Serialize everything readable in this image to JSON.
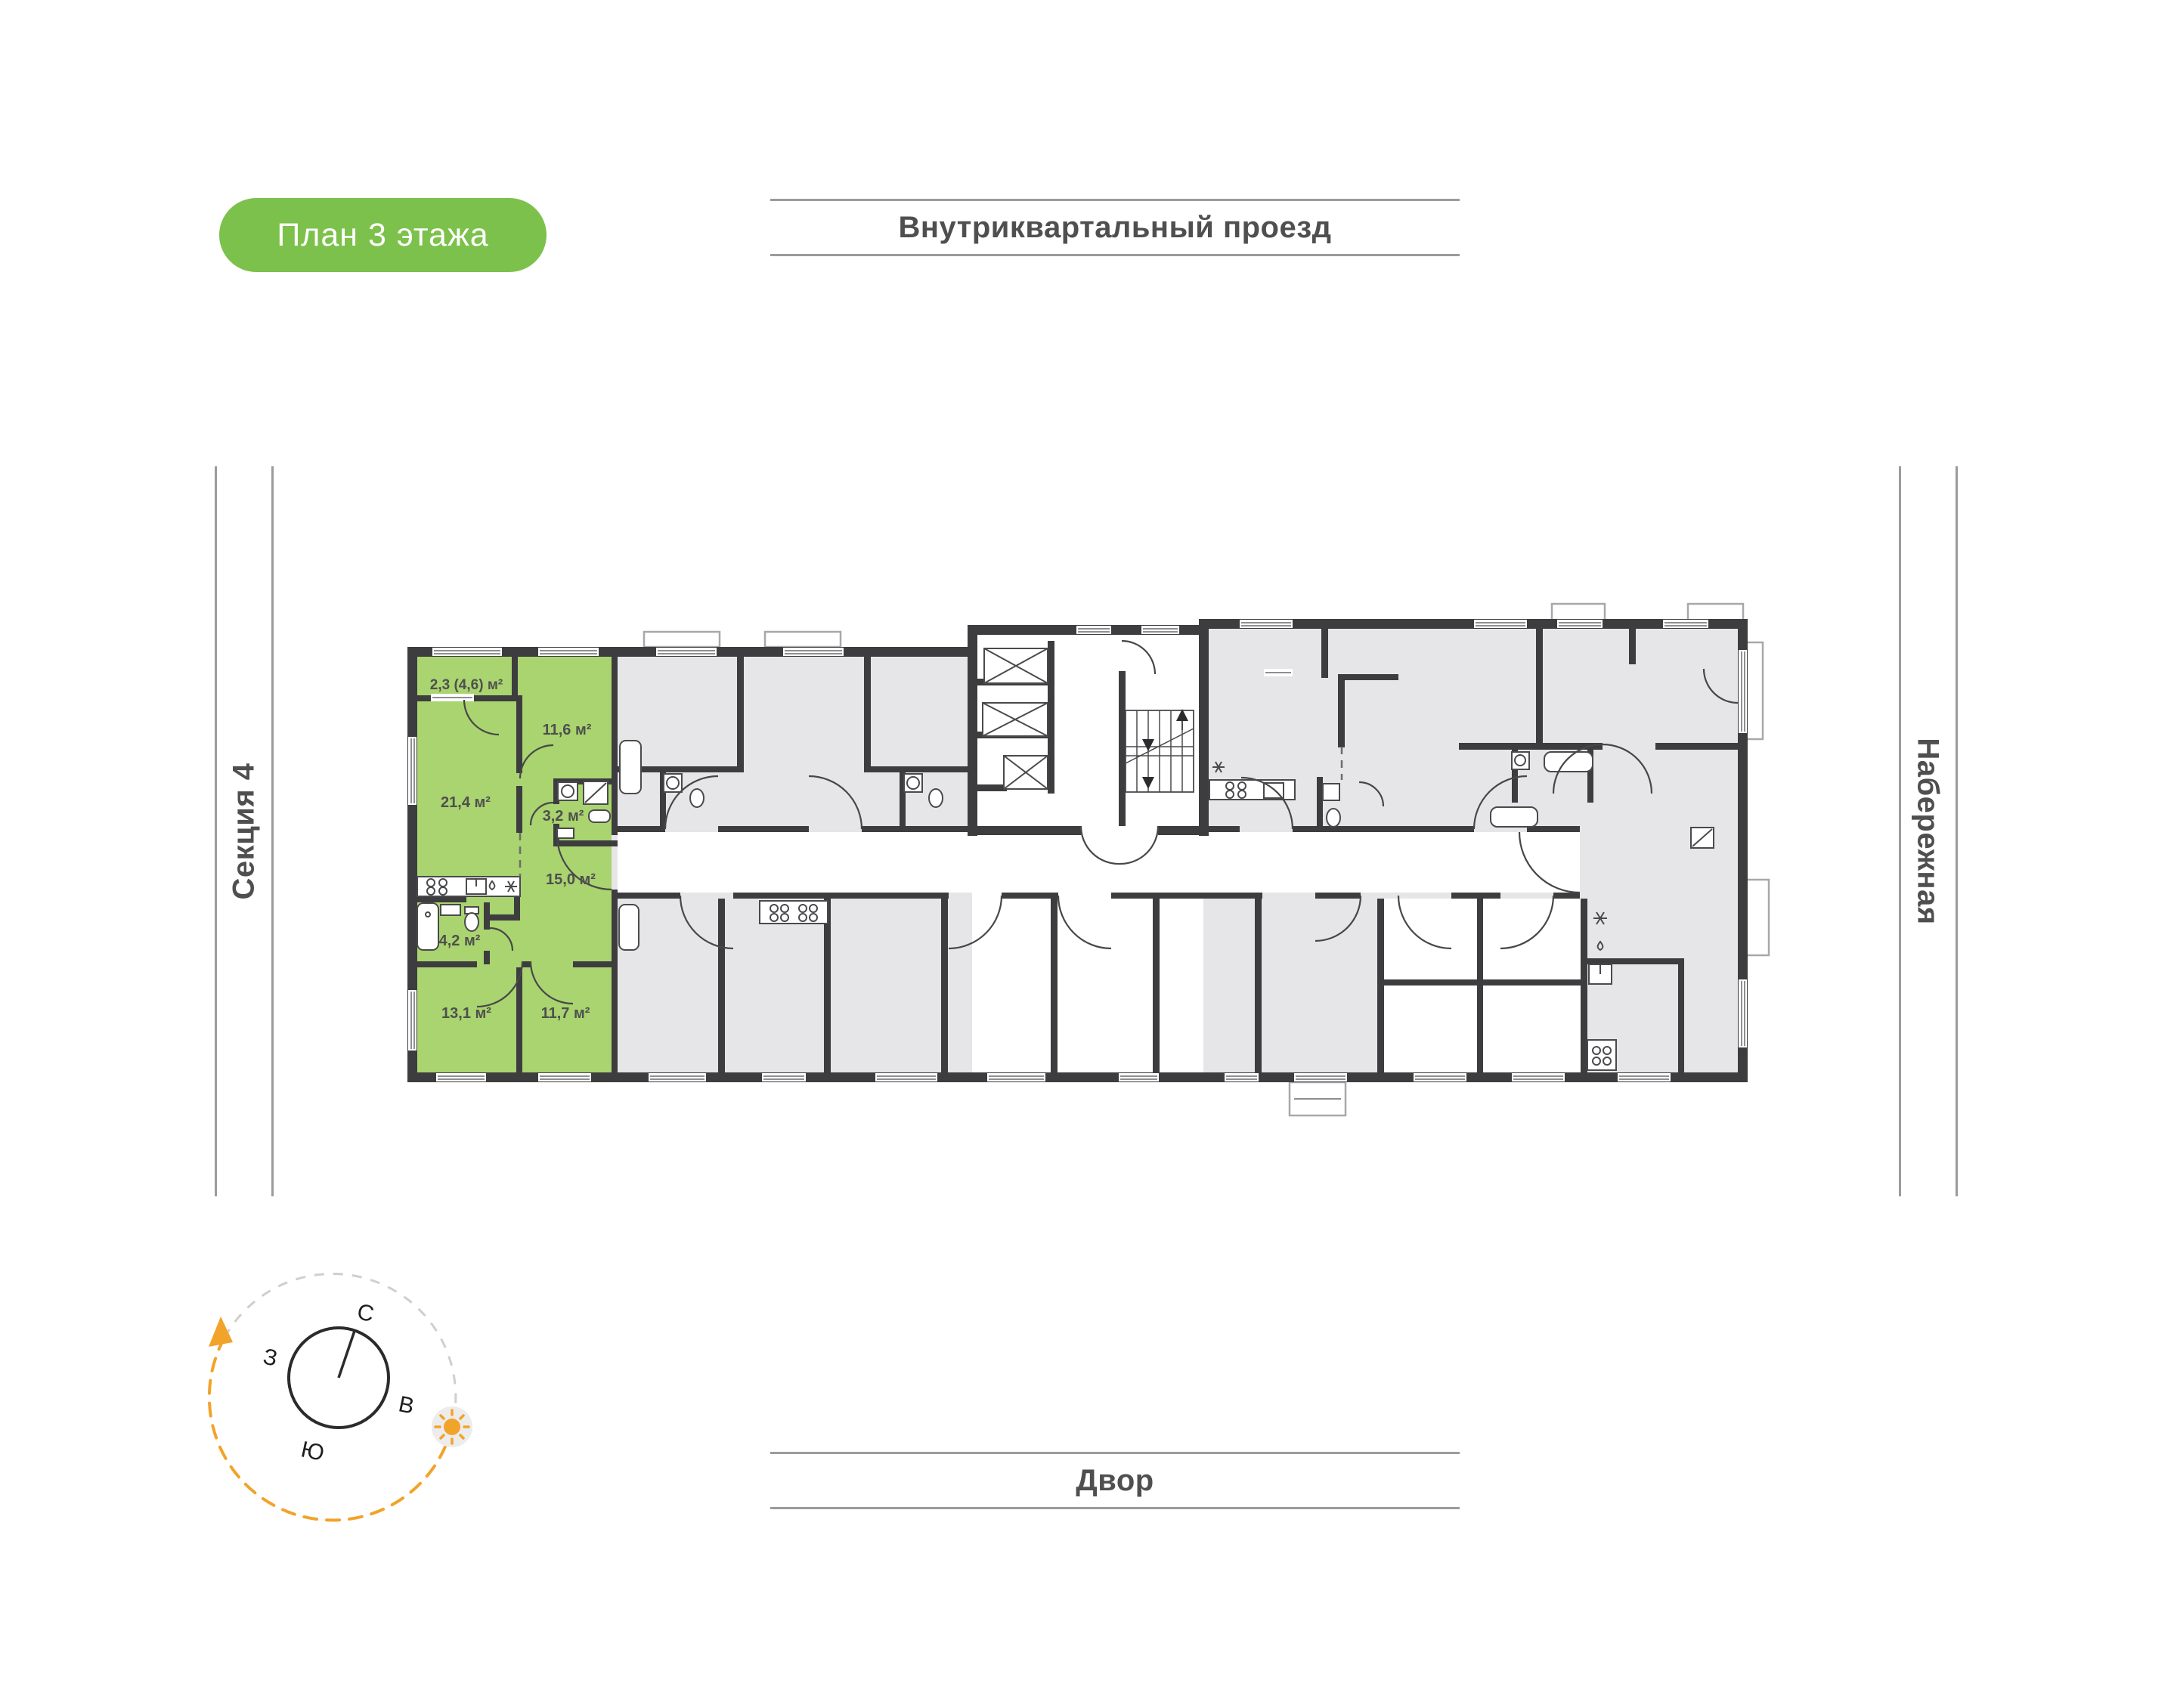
{
  "badge": {
    "label": "План 3 этажа"
  },
  "surroundings": {
    "top_street": "Внутриквартальный проезд",
    "bottom_street": "Двор",
    "left_section": "Секция 4",
    "right_street": "Набережная"
  },
  "compass": {
    "north": "С",
    "east": "В",
    "south": "Ю",
    "west": "З"
  },
  "apartment": {
    "status": "highlighted",
    "rooms": [
      {
        "name": "balcony",
        "area": "2,3 (4,6) м²"
      },
      {
        "name": "bedroom-top",
        "area": "11,6 м²"
      },
      {
        "name": "living-kitchen",
        "area": "21,4 м²"
      },
      {
        "name": "bathroom-small",
        "area": "3,2 м²"
      },
      {
        "name": "hallway",
        "area": "15,0 м²"
      },
      {
        "name": "bathroom",
        "area": "4,2 м²"
      },
      {
        "name": "bedroom-left",
        "area": "13,1 м²"
      },
      {
        "name": "bedroom-right",
        "area": "11,7 м²"
      }
    ]
  },
  "colors": {
    "badge_green": "#7cc14b",
    "apartment_green": "#a9d46f",
    "wall_dark": "#3d3d3f",
    "room_gray": "#e6e6e8",
    "corridor_white": "#ffffff",
    "line_gray": "#9b9b9b",
    "label_gray": "#4f4f4f",
    "accent_orange": "#f2a32a"
  }
}
